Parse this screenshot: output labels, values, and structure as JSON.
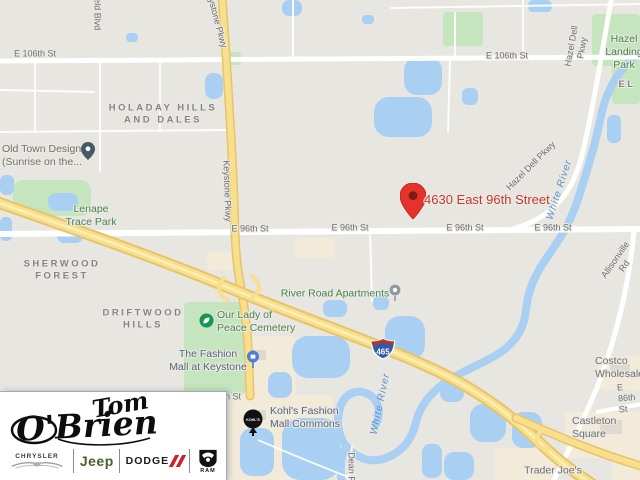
{
  "map": {
    "destination": {
      "label": "4630 East 96th Street"
    },
    "shield": {
      "number": "465"
    },
    "kohls_pin_text": "KOHL'S",
    "colors": {
      "destination_red": "#cb372b",
      "pin_red": "#e5332c",
      "highway_yellow": "#f8df8d",
      "water_blue": "#a9cff2",
      "park_green": "#c5e5be",
      "park_text_green": "#48854a",
      "commercial_beige": "#f3ebd9"
    },
    "labels": [
      {
        "n": "street-e106th-1",
        "t": "E 106th St",
        "x": 35,
        "y": 54,
        "r": 0,
        "c": "road"
      },
      {
        "n": "street-e106th-2",
        "t": "E 106th St",
        "x": 507,
        "y": 56,
        "r": 0,
        "c": "road"
      },
      {
        "n": "street-e96th-1",
        "t": "E 96th St",
        "x": 250,
        "y": 229,
        "r": 0,
        "c": "road"
      },
      {
        "n": "street-e96th-2",
        "t": "E 96th St",
        "x": 350,
        "y": 228,
        "r": 0,
        "c": "road"
      },
      {
        "n": "street-e96th-3",
        "t": "E 96th St",
        "x": 465,
        "y": 228,
        "r": 0,
        "c": "road"
      },
      {
        "n": "street-e96th-4",
        "t": "E 96th St",
        "x": 553,
        "y": 228,
        "r": 0,
        "c": "road"
      },
      {
        "n": "street-e86th",
        "t": "E 86th St",
        "x": 618,
        "y": 399,
        "r": -5,
        "c": "road",
        "a": "left"
      },
      {
        "n": "street-keystone-top",
        "t": "Keystone Pkwy",
        "x": 216,
        "y": 18,
        "r": 75,
        "c": "road"
      },
      {
        "n": "street-keystone-mid",
        "t": "Keystone Pkwy",
        "x": 227,
        "y": 191,
        "r": 88,
        "c": "road"
      },
      {
        "n": "street-field-blvd",
        "t": "field Blvd",
        "x": 97,
        "y": 12,
        "r": 90,
        "c": "road"
      },
      {
        "n": "street-hazel-dell-top",
        "t": "Hazel Dell Pkwy",
        "x": 577,
        "y": 47,
        "r": -80,
        "c": "road"
      },
      {
        "n": "street-hazel-dell-mid",
        "t": "Hazel Dell Pkwy",
        "x": 531,
        "y": 166,
        "r": -45,
        "c": "road"
      },
      {
        "n": "street-allisonville",
        "t": "Allisonville Rd",
        "x": 620,
        "y": 263,
        "r": -55,
        "c": "road"
      },
      {
        "n": "street-fragment-h-st",
        "t": "h St",
        "x": 233,
        "y": 397,
        "r": 0,
        "c": "road"
      },
      {
        "n": "street-dean-rd",
        "t": "Dean Rd",
        "x": 351,
        "y": 470,
        "r": 90,
        "c": "road"
      },
      {
        "n": "hood-holaday",
        "t": "HOLADAY HILLS\nAND DALES",
        "x": 163,
        "y": 114,
        "r": 0,
        "c": "hood"
      },
      {
        "n": "hood-sherwood",
        "t": "SHERWOOD\nFOREST",
        "x": 62,
        "y": 270,
        "r": 0,
        "c": "hood"
      },
      {
        "n": "hood-driftwood",
        "t": "DRIFTWOOD\nHILLS",
        "x": 143,
        "y": 319,
        "r": 0,
        "c": "hood"
      },
      {
        "n": "hood-fragment-el",
        "t": "EL",
        "x": 627,
        "y": 85,
        "r": 0,
        "c": "hood"
      },
      {
        "n": "park-lenape-trace",
        "t": "Lenape\nTrace Park",
        "x": 91,
        "y": 216,
        "r": 0,
        "c": "park"
      },
      {
        "n": "park-hazel-landing",
        "t": "Hazel\nLanding Park",
        "x": 624,
        "y": 52,
        "r": 0,
        "c": "park"
      },
      {
        "n": "poi-our-lady-of-peace-cemetery",
        "t": "Our Lady of\nPeace Cemetery",
        "x": 217,
        "y": 322,
        "r": 0,
        "c": "park",
        "a": "left"
      },
      {
        "n": "poi-river-road-apartments",
        "t": "River Road Apartments",
        "x": 335,
        "y": 294,
        "r": 0,
        "c": "park"
      },
      {
        "n": "poi-old-town-design",
        "t": "Old Town Design\n(Sunrise on the...",
        "x": 2,
        "y": 156,
        "r": 0,
        "c": "poi2",
        "a": "left"
      },
      {
        "n": "poi-fashion-mall",
        "t": "The Fashion\nMall at Keystone",
        "x": 208,
        "y": 361,
        "r": 0,
        "c": "poi"
      },
      {
        "n": "poi-kohls-fashion-mall-commons",
        "t": "Kohl's Fashion\nMall Commons",
        "x": 270,
        "y": 418,
        "r": 0,
        "c": "poi",
        "a": "left"
      },
      {
        "n": "poi-trader-joes",
        "t": "Trader Joe's",
        "x": 553,
        "y": 471,
        "r": 0,
        "c": "poi2"
      },
      {
        "n": "poi-castleton-square",
        "t": "Castleton Square",
        "x": 572,
        "y": 428,
        "r": 0,
        "c": "poi2",
        "a": "left"
      },
      {
        "n": "poi-costco",
        "t": "Costco Wholesale",
        "x": 595,
        "y": 368,
        "r": 0,
        "c": "poi2",
        "a": "left"
      },
      {
        "n": "water-white-river-1",
        "t": "White River",
        "x": 560,
        "y": 190,
        "r": -72,
        "c": "water"
      },
      {
        "n": "water-white-river-2",
        "t": "White River",
        "x": 381,
        "y": 404,
        "r": -78,
        "c": "water"
      }
    ]
  },
  "logo": {
    "signature_line1": "Tom",
    "signature_line2": "O'Brien",
    "brands": {
      "chrysler": "CHRYSLER",
      "jeep": "Jeep",
      "dodge": "DODGE",
      "ram": "RAM"
    }
  }
}
